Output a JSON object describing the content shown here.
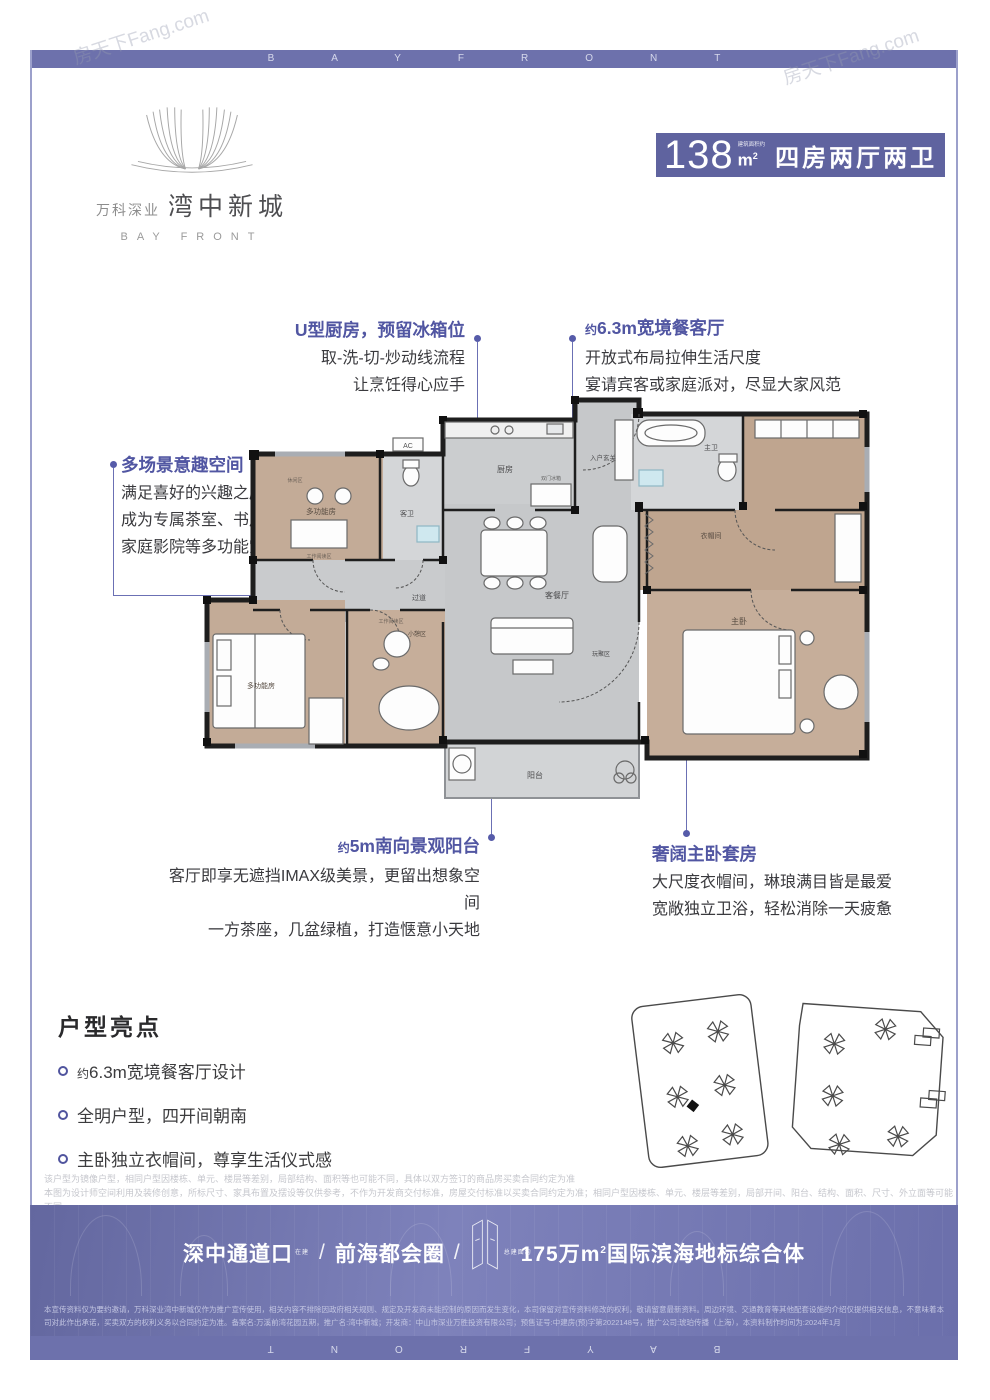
{
  "frame": {
    "letters": "BAYFRONT",
    "watermark": "房天下Fang.com"
  },
  "logo": {
    "brand": "万科深业",
    "name": "湾中新城",
    "subtitle": "BAY FRONT"
  },
  "badge": {
    "area": "138",
    "unit_note": "建筑面积约",
    "unit": "m",
    "unit_sup": "2",
    "layout": "四房两厅两卫"
  },
  "callouts": {
    "kitchen": {
      "title": "U型厨房，预留冰箱位",
      "line1": "取-洗-切-炒动线流程",
      "line2": "让烹饪得心应手"
    },
    "dining": {
      "prefix": "约",
      "title": "6.3m宽境餐客厅",
      "line1": "开放式布局拉伸生活尺度",
      "line2": "宴请宾客或家庭派对，尽显大家风范"
    },
    "multi": {
      "title": "多场景意趣空间",
      "line1": "满足喜好的兴趣之所",
      "line2": "成为专属茶室、书房或",
      "line3": "家庭影院等多功能空间"
    },
    "balcony": {
      "prefix": "约",
      "title": "5m南向景观阳台",
      "line1": "客厅即享无遮挡IMAX级美景，更留出想象空间",
      "line2": "一方茶座，几盆绿植，打造惬意小天地"
    },
    "master": {
      "title": "奢阔主卧套房",
      "line1": "大尺度衣帽间，琳琅满目皆是最爱",
      "line2": "宽敞独立卫浴，轻松消除一天疲惫"
    }
  },
  "floorplan": {
    "rooms": {
      "kitchen": "厨房",
      "fridge": "双门冰箱",
      "entry": "入户玄关",
      "guest_bath": "客卫",
      "multi_top": "多功能房",
      "reading_top": "工作阅读区",
      "leisure": "休闲区",
      "corridor": "过道",
      "living": "客餐厅",
      "play": "玩聚区",
      "balcony": "阳台",
      "multi_bottom": "多功能房",
      "nap": "小憩区",
      "reading_nap": "工作阅读区",
      "master": "主卧",
      "closet": "衣帽间",
      "master_bath": "主卫",
      "ac": "AC"
    }
  },
  "highlights": {
    "heading": "户型亮点",
    "items": [
      {
        "prefix": "约",
        "text": "6.3m宽境餐客厅设计"
      },
      {
        "prefix": "",
        "text": "全明户型，四开间朝南"
      },
      {
        "prefix": "",
        "text": "主卧独立衣帽间，尊享生活仪式感"
      }
    ]
  },
  "disclaimer": {
    "line1": "该户型为镜像户型，相同户型因楼栋、单元、楼层等差别，局部结构、面积等也可能不同，具体以双方签订的商品房买卖合同约定为准",
    "line2": "本图为设计师空间利用及装修创意，所标尺寸、家具布置及摆设等仅供参考，不作为开发商交付标准，房屋交付标准以买卖合同约定为准；相同户型因楼栋、单元、楼层等差别，局部开间、阳台、结构、面积、尺寸、外立面等可能不同。"
  },
  "banner": {
    "segment1": "深中通道口",
    "note1": "在建",
    "sep1": "/",
    "segment2": "前海都会圈",
    "sep2": "/",
    "area_note": "总建面约",
    "area_value": "175万m",
    "area_sup": "2",
    "segment3": "国际滨海地标综合体"
  },
  "legal": {
    "text": "本宣传资料仅为要约邀请，万科深业湾中新城仅作为推广宣传使用，相关内容不排除因政府相关规则、规定及开发商未能控制的原因而发生变化，本司保留对宣传资料修改的权利，敬请留意最新资料。周边环境、交通教育等其他配套设施的介绍仅提供相关信息，不意味着本司对此作出承诺，买卖双方的权利义务以合同约定为准。备案名:万溪前湾花园五期，推广名:湾中新城；开发商：中山市深业万胜投资有限公司；预售证号:中建房(预)字第2022148号，推广公司:琥珀传播（上海），本资料制作时间为:2024年1月"
  }
}
